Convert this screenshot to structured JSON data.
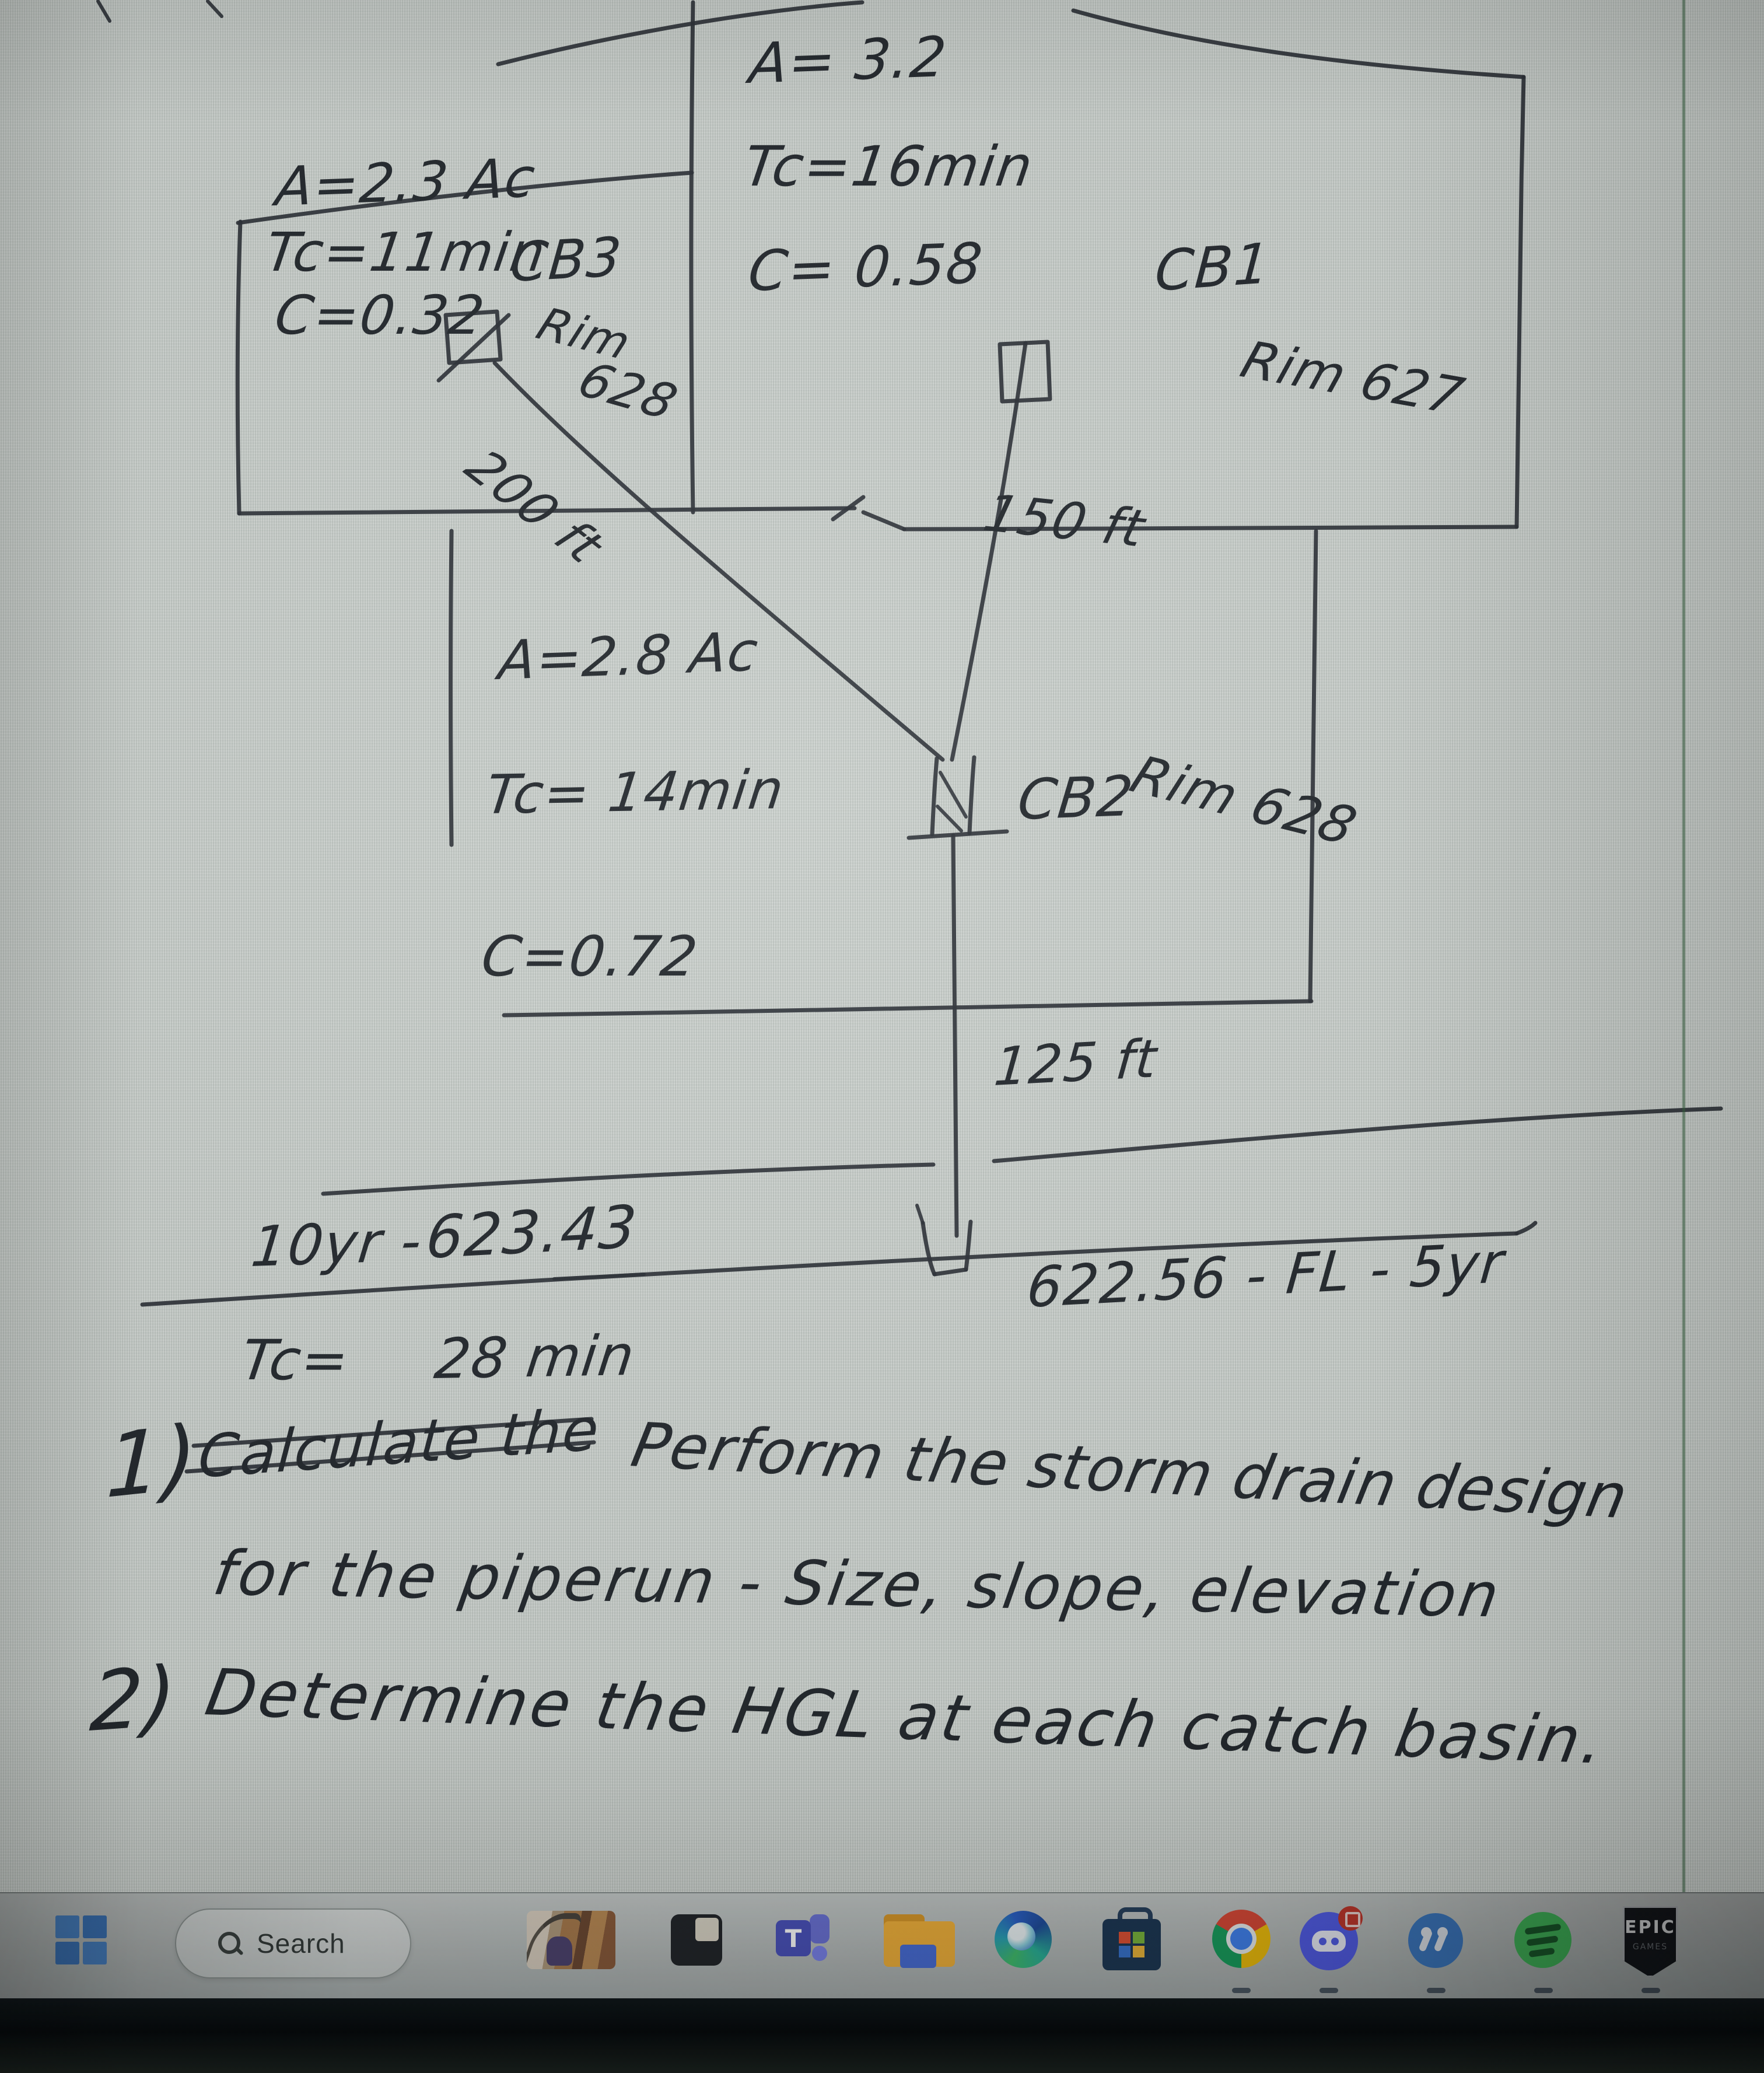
{
  "colors": {
    "ink": "#23282d",
    "page_bg": "#c6ccc8",
    "taskbar_bg": "#b4bab9",
    "seam_green": "#34603e",
    "windows_blue": "#4b87cc"
  },
  "diagram": {
    "basin1": {
      "area": "A= 3.2",
      "tc": "Tc=16min",
      "c": "C= 0.58",
      "label": "CB1",
      "rim": "Rim 627"
    },
    "basin2": {
      "area": "A=2.8 Ac",
      "tc": "Tc= 14min",
      "c": "C=0.72",
      "label": "CB2",
      "rim": "Rim 628"
    },
    "basin3": {
      "area": "A=2.3 Ac",
      "tc": "Tc=11min",
      "c": "C=0.32",
      "label": "CB3",
      "rim_word": "Rim",
      "rim_value": "628"
    },
    "pipes": {
      "cb3_to_cb2": "200 ft",
      "cb1_to_cb2": "150 ft",
      "cb2_to_outfall": "125 ft"
    },
    "outfall_label": "622.56 - FL - 5yr",
    "notes": {
      "line1_label": "10yr -",
      "line1_value": "623.43",
      "line2_label": "Tc=",
      "line2_value": "28 min"
    },
    "problems": {
      "p1_num": "1)",
      "p1_struck": "Calculate the",
      "p1_text": "Perform the storm drain design",
      "p1_cont": "for the piperun - Size, slope, elevation",
      "p2_num": "2)",
      "p2_text": "Determine the HGL at each catch basin."
    }
  },
  "taskbar": {
    "search_label": "Search",
    "epic_title": "EPIC",
    "epic_sub": "GAMES",
    "icons": [
      "windows-start",
      "search",
      "photos-app",
      "dark-window-app",
      "teams",
      "file-explorer",
      "edge",
      "microsoft-store",
      "chrome",
      "discord",
      "blue-circle-app",
      "spotify",
      "epic-games"
    ]
  }
}
